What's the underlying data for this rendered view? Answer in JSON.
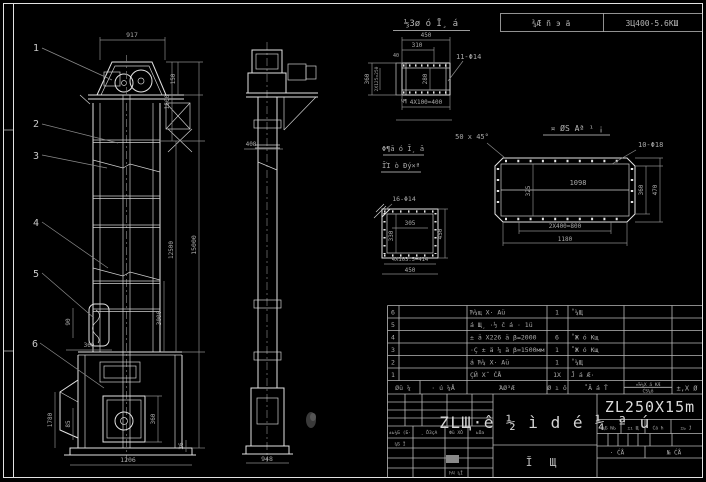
{
  "header": {
    "left": "⅓Зø ó Ī¸ á",
    "center": "¾Æ ñ э ä",
    "right": "ЗЦ400-5.6КШ"
  },
  "balloons": [
    "1",
    "2",
    "3",
    "4",
    "5",
    "6"
  ],
  "front": {
    "d917": "917",
    "d150": "150",
    "d1500": "1500",
    "d15000": "15000",
    "d12500": "12500",
    "d3000": "3000",
    "d90": "90",
    "d360a": "360",
    "d1780": "1780",
    "d85": "85",
    "d1206": "1206",
    "d360b": "360",
    "d26": "26"
  },
  "side": {
    "d408": "408",
    "d948": "948"
  },
  "detailA": {
    "d450": "450",
    "d310": "310",
    "d40": "40",
    "d360": "360",
    "d2x125": "2Х125=250",
    "d280": "280",
    "holes": "11-Φ14",
    "d4x100": "4Х100=400",
    "weld": "Ч¶"
  },
  "detailB": {
    "title": "¤ ØЅ Аª ¹ ¡",
    "chamfer": "50 x 45°",
    "holes": "10-Φ18",
    "inner": "1098",
    "d325": "325",
    "d360": "360",
    "d470": "470",
    "d2x400": "2Х400=800",
    "d1180": "1180"
  },
  "detailC": {
    "title1": "Φ¶ā ó Ī¸ ā",
    "title2": "ĪΊ ò Ðý×ª",
    "holes": "16-Φ14",
    "d305": "305",
    "d330": "330",
    "d450r": "450",
    "d4x103": "4Х103.5=414",
    "d450b": "450"
  },
  "bom": {
    "rows": [
      {
        "no": "6",
        "name": "Ћ¼щ Х· Аü",
        "qty": "1",
        "mat": "˚¼Щ"
      },
      {
        "no": "5",
        "name": "á Щ¸ ·½ č á · 1ü",
        "qty": "",
        "mat": ""
      },
      {
        "no": "4",
        "name": "± ä Х226 ä β=2000",
        "qty": "6",
        "mat": "˚Ж ó Кщ"
      },
      {
        "no": "3",
        "name": "·Ç ± ä ¼ ä β=1500мм",
        "qty": "1",
        "mat": "˚Ж ó Кщ"
      },
      {
        "no": "2",
        "name": "á Ћ¼ Х· Аü",
        "qty": "1",
        "mat": "˚¼Щ"
      },
      {
        "no": "1",
        "name": "ÇЙ Х˝ ĆÅ",
        "qty": "1Х",
        "mat": "Ĵ á Æ·"
      }
    ],
    "footer": {
      "c1": "Øü ¼",
      "c2": "· ú ¼Å",
      "c3": "ΆØ³Æ",
      "c4": "Ø ı ô",
      "c5": "˚Ā á Ť",
      "c6a": "¤Ћ¼Х ä КÆ",
      "c6b": "ĆЅ¼ô",
      "c7": "±,Х Ø"
    }
  },
  "titleblock": {
    "main": "ZLЩ·ê ½ ì d é ¼ ª ú",
    "model": "ZL250X15m",
    "sub1": "Ĭ",
    "sub2": "Щ",
    "sign": {
      "a": "±ь¼Б (Б·",
      "b": "¸ ĎЗçА",
      "c": "Фü ХŎ",
      "d": "ьŌа",
      "e": "¼Б Ĭ",
      "f": "ħЧ ¼Ĭ"
    },
    "right": {
      "h1": "¼Б ЊЬ",
      "h2": "±ı Щ",
      "h3": "Ćā ħ",
      "h4": "±ь Ĵ",
      "s1": "· ĆÅ",
      "s2": "№ ĆÅ"
    }
  },
  "colors": {
    "background": "#000000",
    "line": "#e2e2e2",
    "dim_line": "#8b8b8b",
    "text": "#a9a9a9"
  }
}
